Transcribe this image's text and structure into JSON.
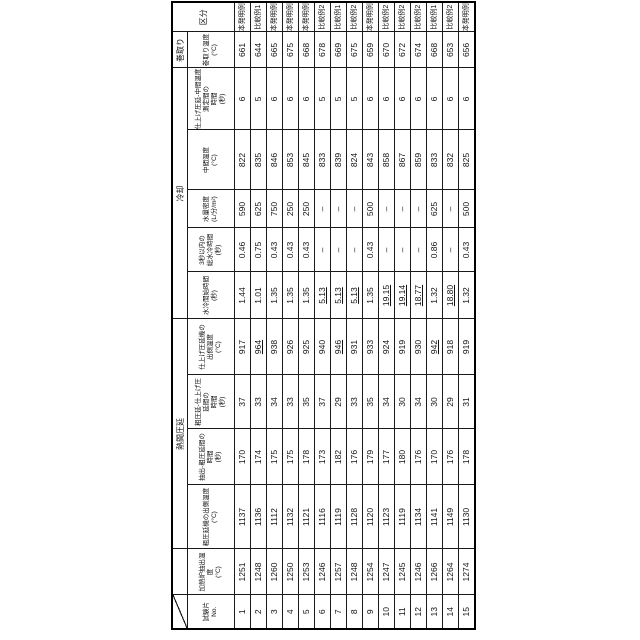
{
  "page": {
    "background": "#ffffff",
    "table_border_color": "#1a1a1a"
  },
  "table": {
    "groups": [
      {
        "label": "熱間圧延",
        "span": 4
      },
      {
        "label": "冷却",
        "span": 5
      },
      {
        "label": "巻取り",
        "span": 1
      }
    ],
    "columns": [
      {
        "id": "specimen_no",
        "label": "試験片\nNo.",
        "width": 34
      },
      {
        "id": "furnace_extraction_temp",
        "label": "加熱炉抽出温度\n(°C)",
        "width": 46
      },
      {
        "id": "rough_mill_exit_temp",
        "label": "粗圧延機の出側温度\n(°C)",
        "width": 64
      },
      {
        "id": "extraction_to_rough_rolling_time",
        "label": "抽出-粗圧延間の\n時間\n(秒)",
        "width": 56
      },
      {
        "id": "rough_to_finish_rolling_time",
        "label": "粗圧延-仕上げ圧延間の\n時間\n(秒)",
        "width": 54
      },
      {
        "id": "finish_mill_exit_temp",
        "label": "仕上げ圧延機の\n出側温度\n(°C)",
        "width": 56
      },
      {
        "id": "water_cooling_start_time",
        "label": "水冷開始時間\n(秒)",
        "width": 47
      },
      {
        "id": "total_water_cooling_time_within_3s",
        "label": "3秒以内の\n総水冷時間\n(秒)",
        "width": 44
      },
      {
        "id": "water_density",
        "label": "水量密度\n(L/分/m²)",
        "width": 38
      },
      {
        "id": "intermediate_temp",
        "label": "中間温度\n(°C)",
        "width": 60
      },
      {
        "id": "finish_to_intermediate_measure_time",
        "label": "仕上げ圧延-中間温度測定間の\n時間\n(秒)",
        "width": 62
      },
      {
        "id": "coiling_temp",
        "label": "巻取り温度\n(°C)",
        "width": 36
      },
      {
        "id": "classification",
        "label": "区分",
        "width": 30
      }
    ],
    "rows": [
      [
        "1",
        "1251",
        "1137",
        "170",
        "37",
        "917",
        "1.44",
        "0.46",
        "590",
        "822",
        "6",
        "661",
        "本発明例"
      ],
      [
        "2",
        "1248",
        "1136",
        "174",
        "33",
        "964",
        "1.01",
        "0.75",
        "625",
        "835",
        "5",
        "644",
        "比較例1"
      ],
      [
        "3",
        "1260",
        "1112",
        "175",
        "34",
        "938",
        "1.35",
        "0.43",
        "750",
        "846",
        "6",
        "665",
        "本発明例"
      ],
      [
        "4",
        "1250",
        "1132",
        "175",
        "33",
        "926",
        "1.35",
        "0.43",
        "250",
        "853",
        "6",
        "675",
        "本発明例"
      ],
      [
        "5",
        "1253",
        "1121",
        "178",
        "35",
        "925",
        "1.35",
        "0.43",
        "250",
        "845",
        "6",
        "668",
        "本発明例"
      ],
      [
        "6",
        "1246",
        "1116",
        "173",
        "37",
        "940",
        "5.13",
        "–",
        "–",
        "833",
        "5",
        "678",
        "比較例2"
      ],
      [
        "7",
        "1257",
        "1119",
        "182",
        "29",
        "946",
        "5.13",
        "–",
        "–",
        "839",
        "5",
        "669",
        "比較例1"
      ],
      [
        "8",
        "1248",
        "1128",
        "176",
        "33",
        "931",
        "5.13",
        "–",
        "–",
        "824",
        "5",
        "675",
        "比較例2"
      ],
      [
        "9",
        "1254",
        "1120",
        "179",
        "35",
        "933",
        "1.35",
        "0.43",
        "500",
        "843",
        "6",
        "659",
        "本発明例"
      ],
      [
        "10",
        "1247",
        "1123",
        "177",
        "34",
        "924",
        "19.15",
        "–",
        "–",
        "858",
        "6",
        "670",
        "比較例2"
      ],
      [
        "11",
        "1245",
        "1119",
        "180",
        "30",
        "919",
        "19.14",
        "–",
        "–",
        "867",
        "6",
        "672",
        "比較例2"
      ],
      [
        "12",
        "1246",
        "1134",
        "176",
        "34",
        "930",
        "18.77",
        "–",
        "–",
        "859",
        "6",
        "674",
        "比較例2"
      ],
      [
        "13",
        "1266",
        "1141",
        "170",
        "30",
        "942",
        "1.32",
        "0.86",
        "625",
        "833",
        "6",
        "668",
        "比較例1"
      ],
      [
        "14",
        "1264",
        "1149",
        "176",
        "29",
        "918",
        "18.80",
        "–",
        "–",
        "832",
        "6",
        "653",
        "比較例2"
      ],
      [
        "15",
        "1274",
        "1130",
        "178",
        "31",
        "919",
        "1.32",
        "0.43",
        "500",
        "825",
        "6",
        "656",
        "本発明例"
      ]
    ],
    "underlined_cells": [
      [
        1,
        5
      ],
      [
        6,
        5
      ],
      [
        12,
        5
      ],
      [
        5,
        6
      ],
      [
        6,
        6
      ],
      [
        7,
        6
      ],
      [
        9,
        6
      ],
      [
        10,
        6
      ],
      [
        11,
        6
      ],
      [
        13,
        6
      ]
    ]
  }
}
